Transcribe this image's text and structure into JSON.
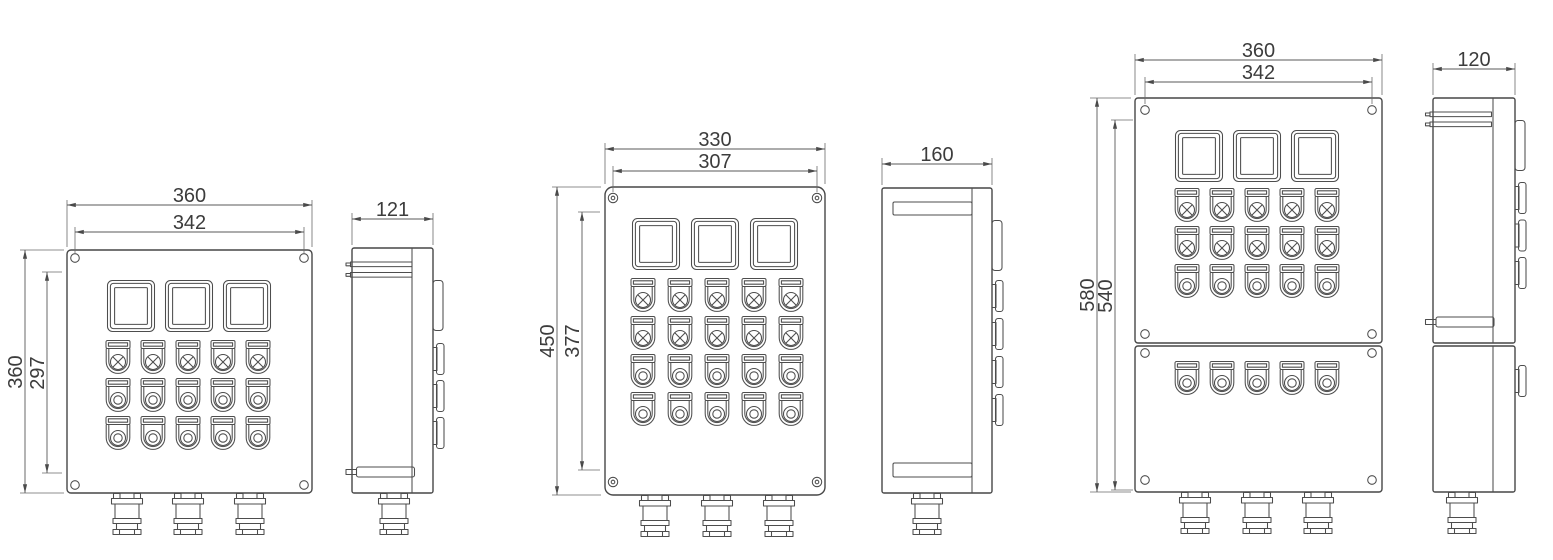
{
  "drawing": {
    "background_color": "#ffffff",
    "line_color": "#4a4a4a",
    "text_color": "#3c3c3c",
    "views": {
      "left_front": {
        "width": "360",
        "mount_width": "342",
        "height": "360",
        "mount_height": "297"
      },
      "left_side": {
        "depth": "121"
      },
      "middle_front": {
        "width": "330",
        "mount_width": "307",
        "height": "450",
        "mount_height": "377"
      },
      "middle_side": {
        "depth": "160"
      },
      "right_front": {
        "width": "360",
        "mount_width": "342",
        "height": "580",
        "mount_height": "540"
      },
      "right_side": {
        "depth": "120"
      }
    },
    "components": {
      "window": "indicator-window",
      "button_x": "selector-pushbutton",
      "button_o": "pushbutton",
      "gland": "cable-gland",
      "screw": "screw-hole"
    }
  }
}
